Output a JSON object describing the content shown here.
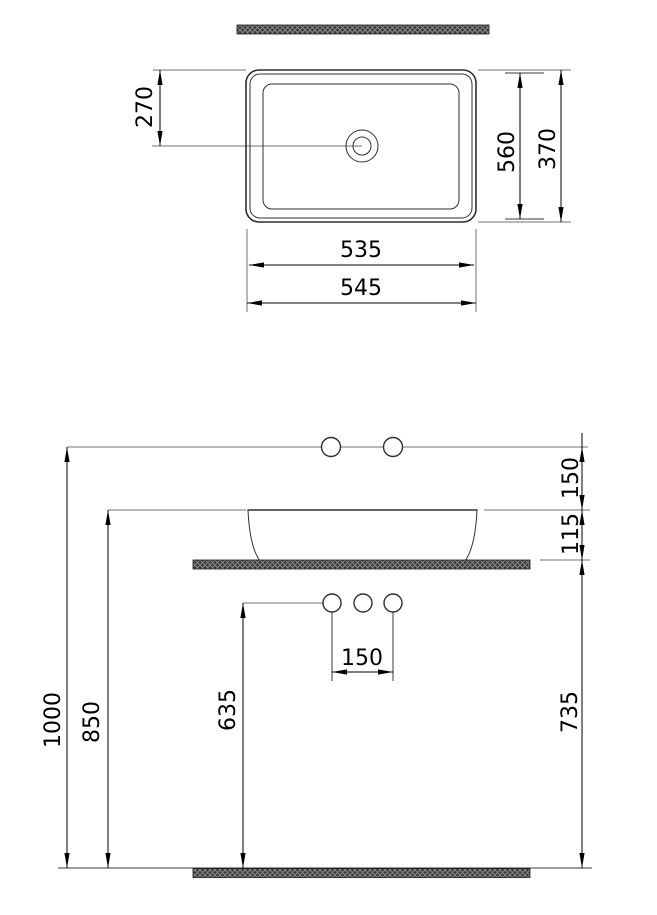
{
  "colors": {
    "line": "#2f2f2f",
    "dimension": "#000000",
    "construction": "#707070",
    "hatch_dark": "#3a3a3a",
    "hatch_light": "#8f8f8f"
  },
  "top_view": {
    "drain_offset": "270",
    "inner_depth": "560",
    "outer_depth": "370",
    "inner_width": "535",
    "outer_width": "545"
  },
  "front_view": {
    "supply_above_rim": "150",
    "rim_above_counter": "115",
    "faucet_hole_spacing": "150",
    "drain_height": "635",
    "rim_height": "850",
    "supply_height": "1000",
    "counter_height": "735"
  }
}
